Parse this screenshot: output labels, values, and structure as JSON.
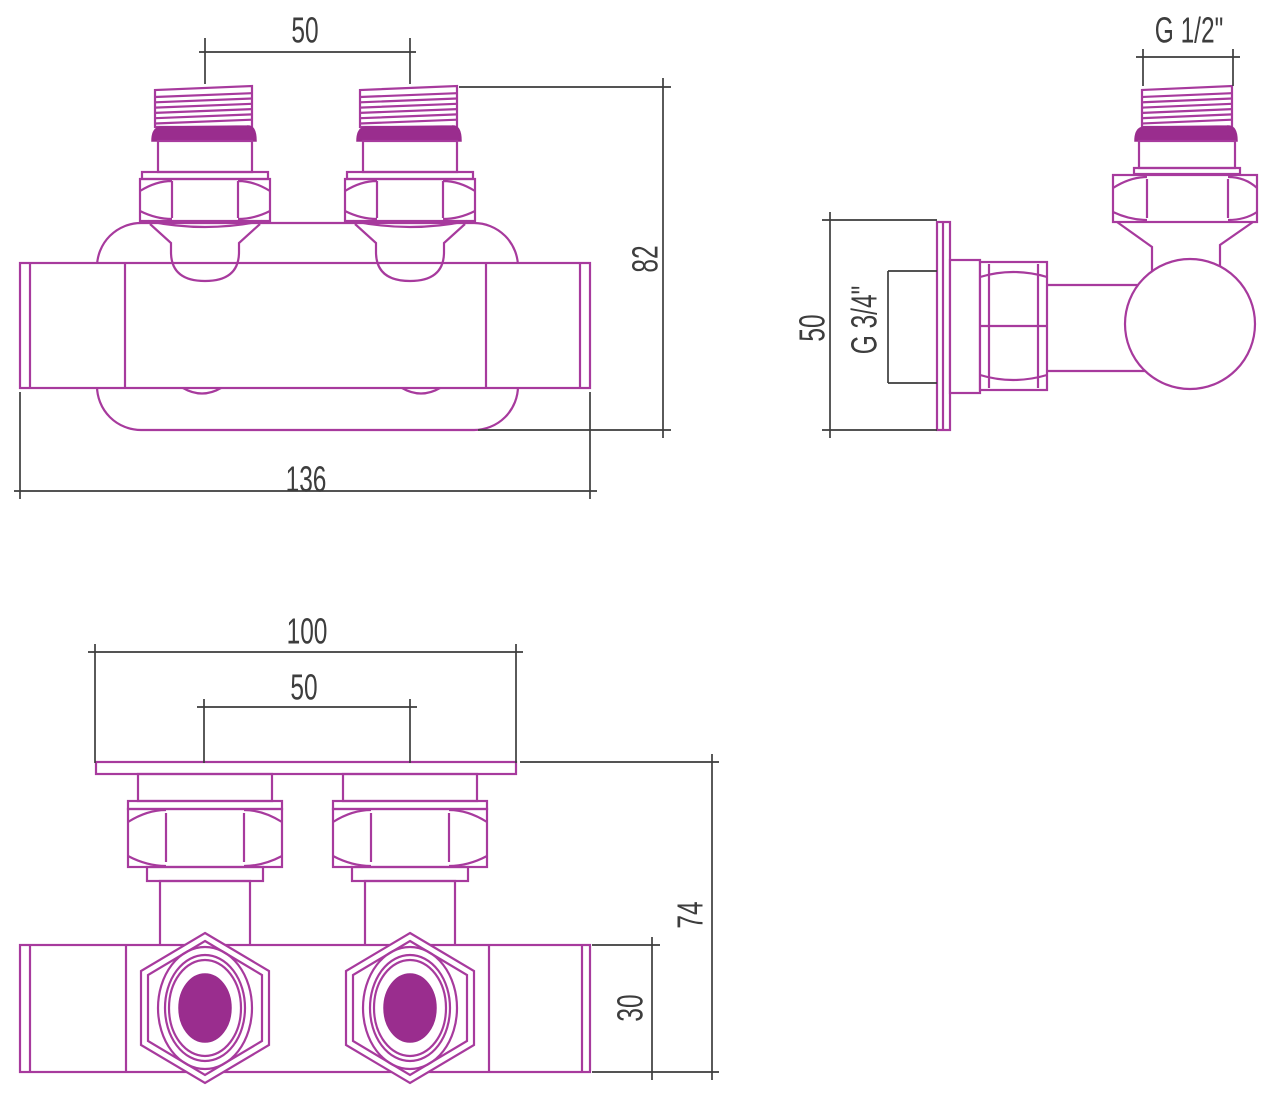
{
  "colors": {
    "outline": "#a73a9d",
    "solid_fill": "#9a2d8e",
    "dimension": "#3d3d3d",
    "background": "#ffffff"
  },
  "views": {
    "front": {
      "dim_port_spacing": "50",
      "dim_height": "82",
      "dim_length": "136"
    },
    "side": {
      "dim_thread_top": "G 1/2\"",
      "dim_plate_height": "50",
      "dim_thread_inner": "G 3/4\""
    },
    "bottom": {
      "dim_plate_width": "100",
      "dim_port_spacing": "50",
      "dim_overall_height": "74",
      "dim_body_height": "30"
    }
  }
}
